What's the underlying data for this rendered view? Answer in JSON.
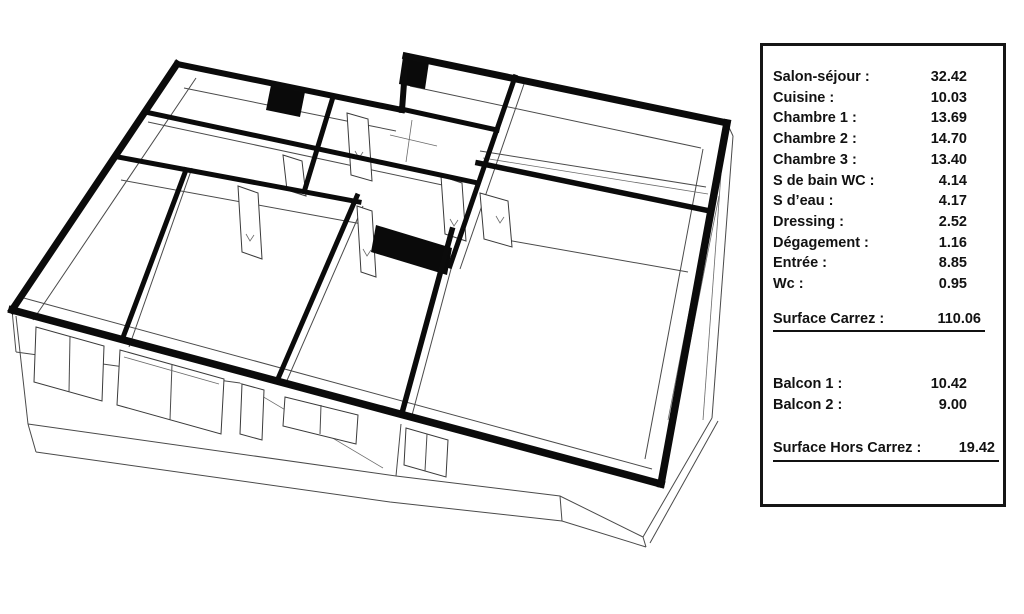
{
  "colors": {
    "wall": "#0b0b0b",
    "thin_line": "#4a4a4a",
    "panel_border": "#161616",
    "background": "#ffffff",
    "text": "#121212"
  },
  "surface_panel": {
    "rows": [
      {
        "label": "Salon-séjour :",
        "value": "32.42"
      },
      {
        "label": "Cuisine :",
        "value": "10.03"
      },
      {
        "label": "Chambre 1 :",
        "value": "13.69"
      },
      {
        "label": "Chambre 2 :",
        "value": "14.70"
      },
      {
        "label": "Chambre 3 :",
        "value": "13.40"
      },
      {
        "label": "S de bain WC :",
        "value": "4.14"
      },
      {
        "label": "S d’eau :",
        "value": "4.17"
      },
      {
        "label": "Dressing :",
        "value": "2.52"
      },
      {
        "label": "Dégagement :",
        "value": "1.16"
      },
      {
        "label": "Entrée :",
        "value": "8.85"
      },
      {
        "label": "Wc :",
        "value": "0.95"
      }
    ],
    "surface_carrez": {
      "label": "Surface Carrez :",
      "value": "110.06"
    },
    "balcony_rows": [
      {
        "label": "Balcon 1 :",
        "value": "10.42"
      },
      {
        "label": "Balcon 2 :",
        "value": "9.00"
      }
    ],
    "surface_hors_carrez": {
      "label": "Surface Hors Carrez :",
      "value": "19.42"
    }
  }
}
